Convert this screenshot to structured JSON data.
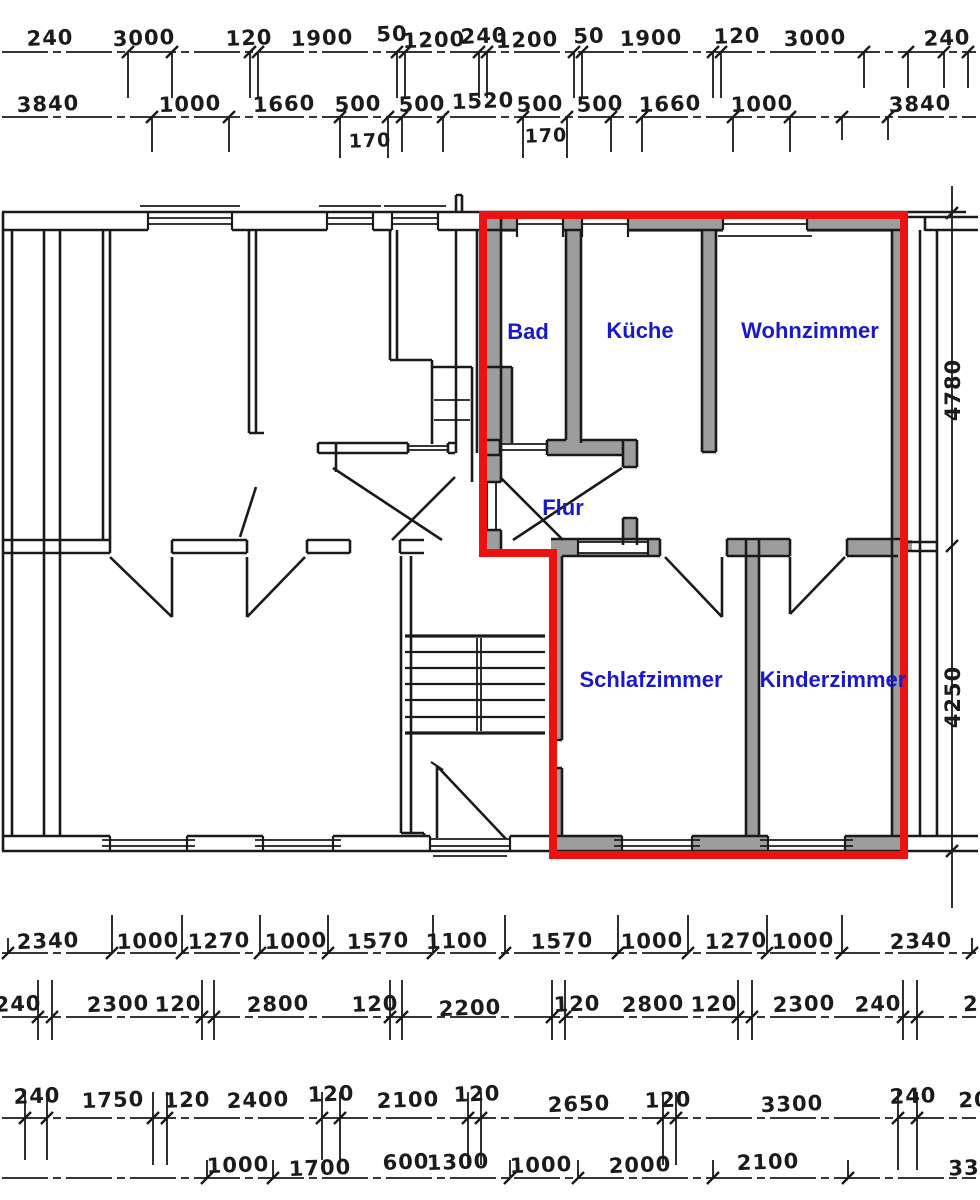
{
  "rooms": {
    "bad": "Bad",
    "kueche": "Küche",
    "wohnzimmer": "Wohnzimmer",
    "flur": "Flur",
    "schlafzimmer": "Schlafzimmer",
    "kinderzimmer": "Kinderzimmer"
  },
  "dims": {
    "top_row1": [
      "240",
      "3000",
      "120",
      "1900",
      "50",
      "1200",
      "240",
      "1200",
      "50",
      "1900",
      "120",
      "3000",
      "240"
    ],
    "top_row2": [
      "3840",
      "1000",
      "1660",
      "500",
      "500",
      "1520",
      "500",
      "500",
      "1660",
      "1000",
      "3840"
    ],
    "top_row2_sub": [
      "170",
      "170"
    ],
    "side": [
      "4780",
      "4250"
    ],
    "bottom_row1": [
      "2340",
      "1000",
      "1270",
      "1000",
      "1570",
      "1100",
      "1570",
      "1000",
      "1270",
      "1000",
      "2340"
    ],
    "bottom_row2": [
      "240",
      "2300",
      "120",
      "2800",
      "120",
      "2200",
      "120",
      "2800",
      "120",
      "2300",
      "240",
      "2"
    ],
    "bottom_row3": [
      "240",
      "1750",
      "120",
      "2400",
      "120",
      "2100",
      "120",
      "2650",
      "120",
      "3300",
      "240",
      "20"
    ],
    "bottom_row4": [
      "1000",
      "1700",
      "600",
      "1300",
      "1000",
      "2000",
      "2100",
      "33"
    ]
  },
  "colors": {
    "highlight_outline": "#ee1111",
    "room_label": "#1a18cd",
    "wall_fill": "#9d9d9d",
    "line": "#1a1a1a"
  }
}
